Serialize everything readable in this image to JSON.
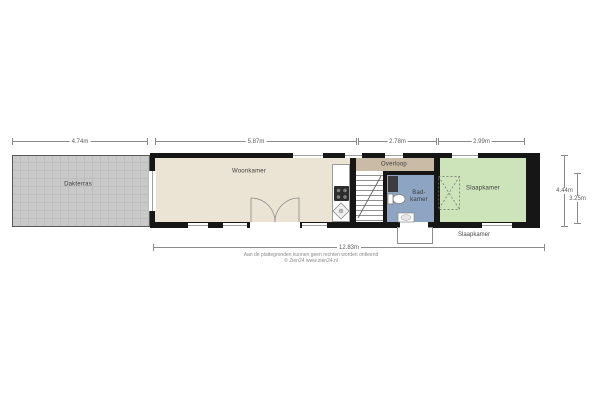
{
  "plan": {
    "rooms": {
      "dakterras": "Dakterras",
      "woonkamer": "Woonkamer",
      "overloop": "Overloop",
      "badkamer": "Bad-kamer",
      "slaapkamer": "Slaapkamer"
    },
    "dimensions": {
      "dakterras_width": "4.74m",
      "woonkamer_width": "5.87m",
      "overloop_width": "2.78m",
      "slaapkamer_width": "2.99m",
      "total_width": "12.83m",
      "depth_outer": "4.44m",
      "depth_inner": "3.25m"
    },
    "captions": {
      "floor_caption": "Slaapkamer",
      "disclaimer_line1": "Aan de plattegronden kunnen geen rechten worden ontleend",
      "disclaimer_line2": "© Zien24 www.zien24.nl"
    },
    "colors": {
      "wall": "#161616",
      "living_room": "#ebe3d3",
      "landing": "#c9bba6",
      "bathroom": "#8da5c2",
      "bedroom": "#cde3ba",
      "terrace": "#c9c9c9"
    }
  }
}
